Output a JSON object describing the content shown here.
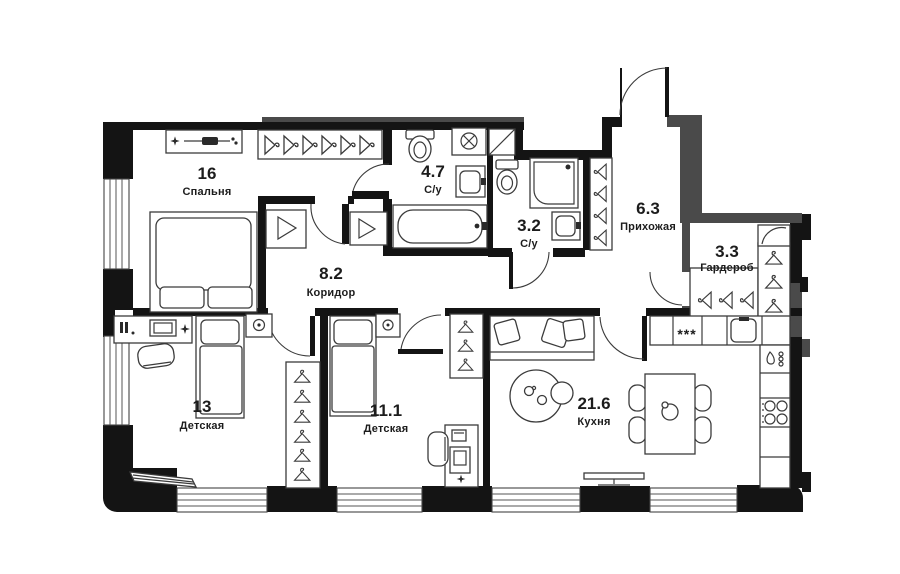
{
  "plan": {
    "title": "apartment-floor-plan",
    "rooms": [
      {
        "id": "bedroom",
        "area": "16",
        "name": "Спальня"
      },
      {
        "id": "corridor",
        "area": "8.2",
        "name": "Коридор"
      },
      {
        "id": "bathroom-large",
        "area": "4.7",
        "name": "С/у"
      },
      {
        "id": "bathroom-small",
        "area": "3.2",
        "name": "С/у"
      },
      {
        "id": "hallway",
        "area": "6.3",
        "name": "Прихожая"
      },
      {
        "id": "wardrobe",
        "area": "3.3",
        "name": "Гардероб"
      },
      {
        "id": "kids-room-1",
        "area": "13",
        "name": "Детская"
      },
      {
        "id": "kids-room-2",
        "area": "11.1",
        "name": "Детская"
      },
      {
        "id": "kitchen",
        "area": "21.6",
        "name": "Кухня"
      }
    ],
    "icons": {
      "hob_knobs": "***"
    },
    "colors": {
      "wall": "#141414",
      "wall_secondary": "#4a4a4a",
      "furniture_line": "#3b3b3b",
      "text": "#1c1c1c",
      "background": "#ffffff"
    }
  }
}
